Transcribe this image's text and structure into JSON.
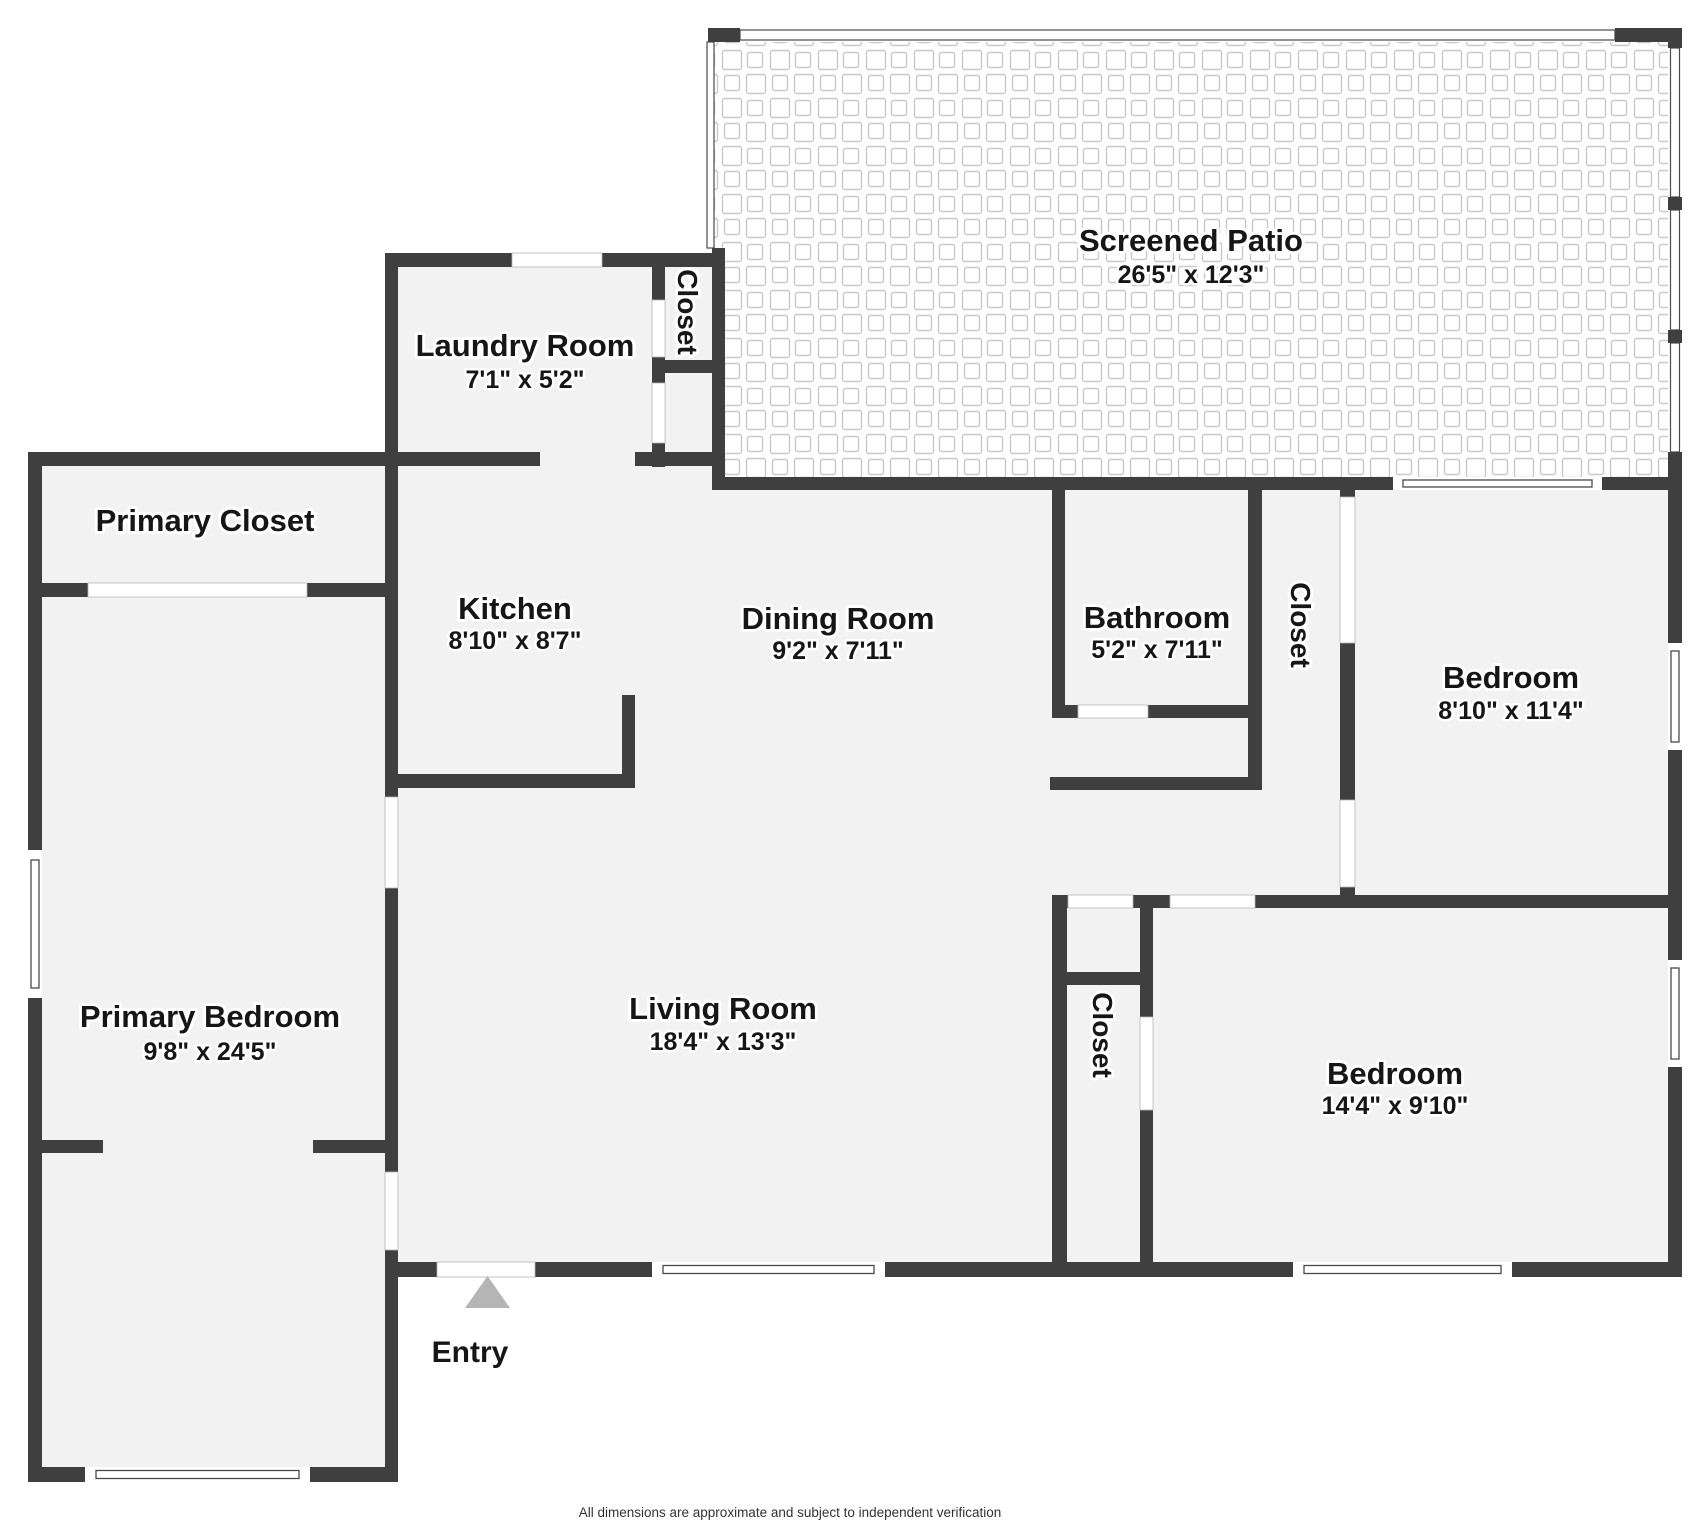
{
  "floorplan": {
    "footer": "All dimensions are approximate and subject to independent verification",
    "entry_label": "Entry",
    "rooms": [
      {
        "name": "Screened Patio",
        "dims": "26'5\" x 12'3\""
      },
      {
        "name": "Laundry Room",
        "dims": "7'1\" x 5'2\""
      },
      {
        "name": "Closet",
        "dims": ""
      },
      {
        "name": "Primary Closet",
        "dims": ""
      },
      {
        "name": "Kitchen",
        "dims": "8'10\" x 8'7\""
      },
      {
        "name": "Dining Room",
        "dims": "9'2\" x 7'11\""
      },
      {
        "name": "Bathroom",
        "dims": "5'2\" x 7'11\""
      },
      {
        "name": "Closet",
        "dims": ""
      },
      {
        "name": "Bedroom",
        "dims": "8'10\" x 11'4\""
      },
      {
        "name": "Primary Bedroom",
        "dims": "9'8\" x 24'5\""
      },
      {
        "name": "Living Room",
        "dims": "18'4\" x 13'3\""
      },
      {
        "name": "Closet",
        "dims": ""
      },
      {
        "name": "Bedroom",
        "dims": "14'4\" x 9'10\""
      }
    ],
    "colors": {
      "wall": "#3f3f3f",
      "floor": "#f2f2f2",
      "tile_line": "#c9c9c9",
      "entry_marker": "#b5b5b5"
    }
  }
}
